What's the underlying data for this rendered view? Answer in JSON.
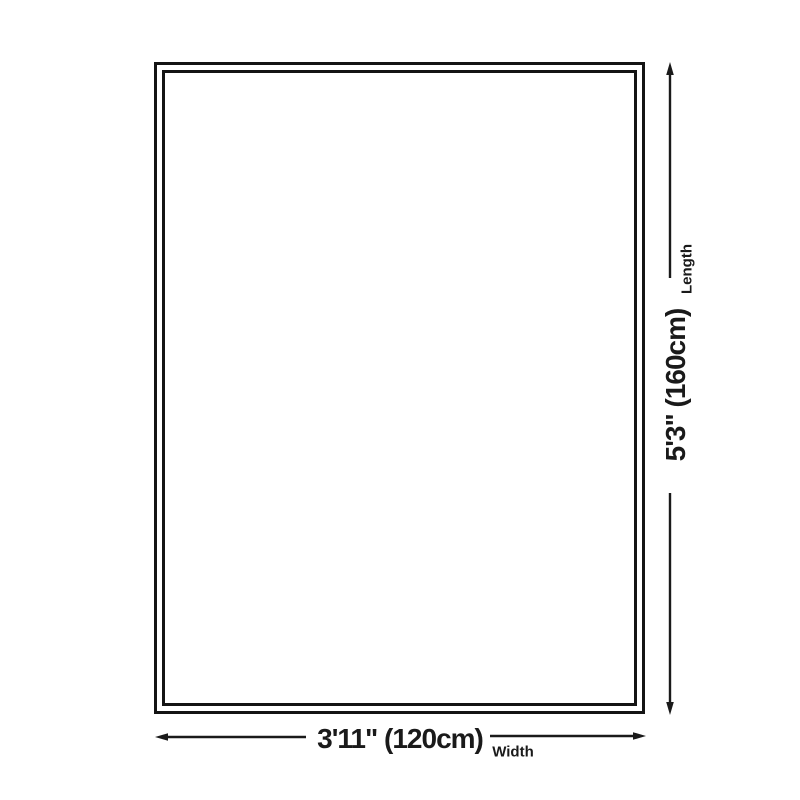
{
  "diagram": {
    "length": {
      "value": "5'3\" (160cm)",
      "label": "Length"
    },
    "width": {
      "value": "3'11\" (120cm)",
      "label": "Width"
    }
  },
  "colors": {
    "line": "#1a1a1a",
    "outline": "#141414",
    "background": "#ffffff"
  }
}
